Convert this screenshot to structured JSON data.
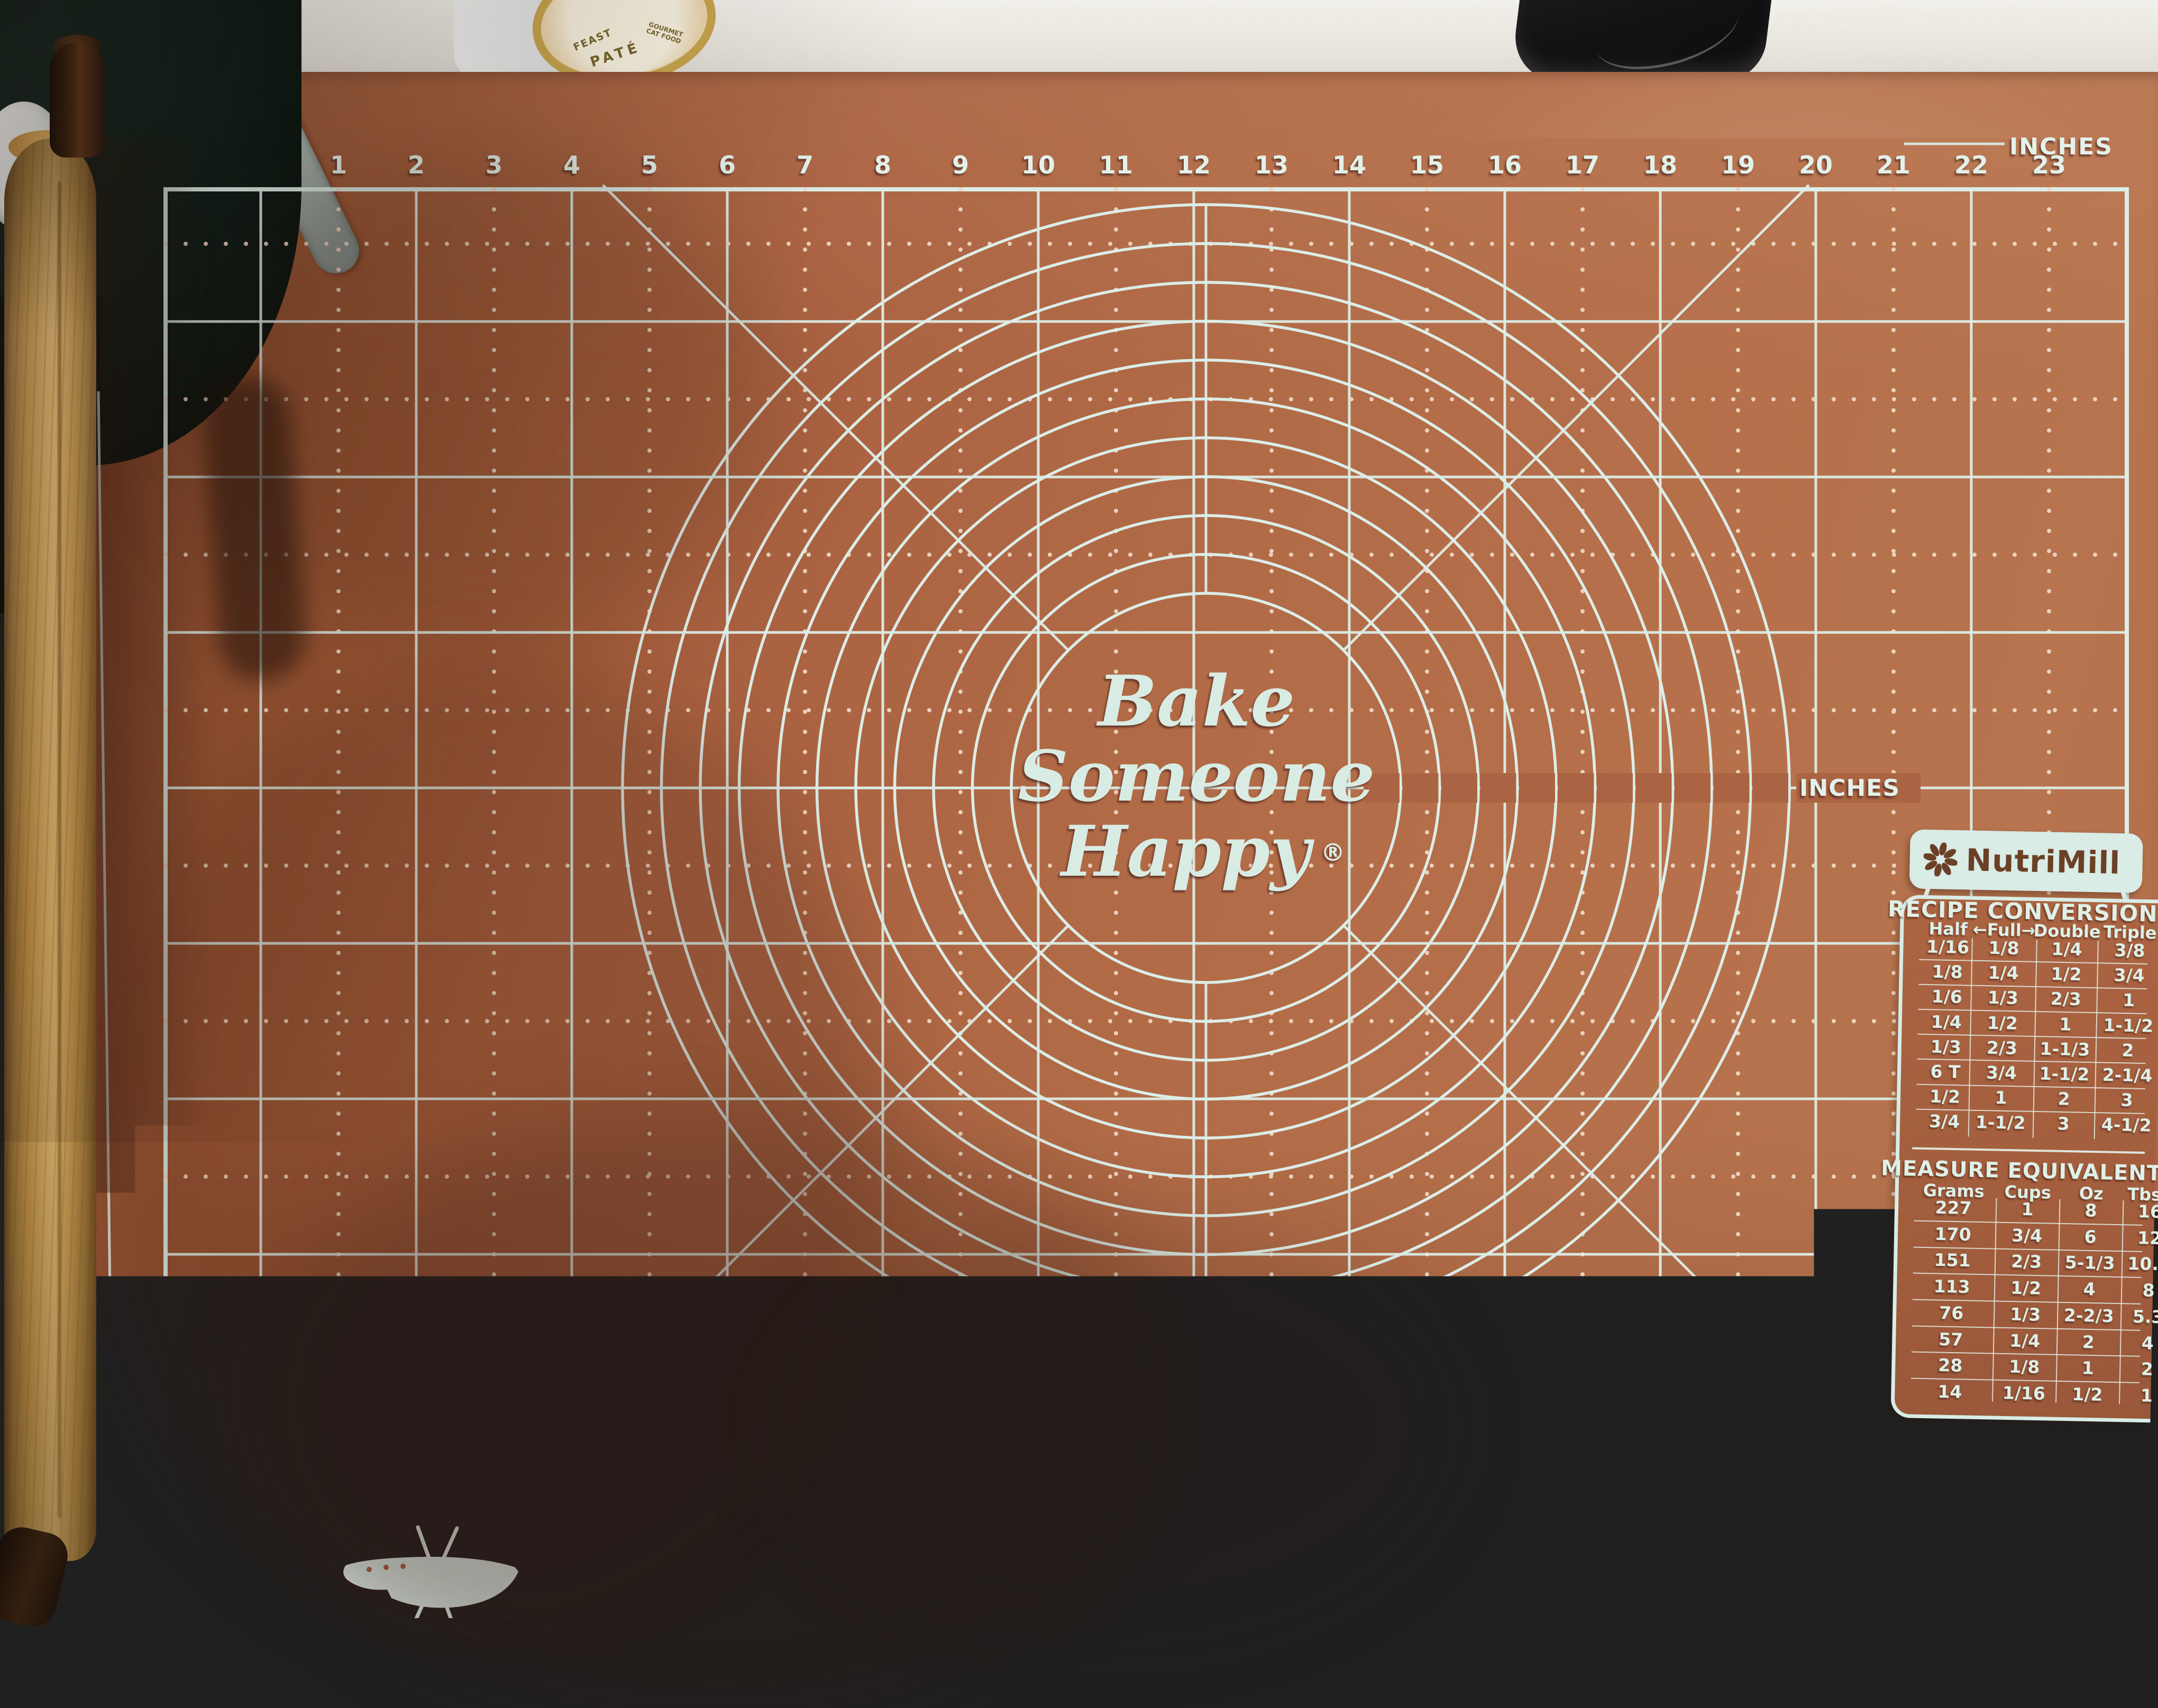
{
  "mat": {
    "center_logo": {
      "line1": "Bake",
      "line2": "Someone",
      "line3": "Happy",
      "registered": "®"
    },
    "rulers": {
      "top": {
        "unit": "INCHES",
        "numbers": [
          1,
          2,
          3,
          4,
          5,
          6,
          7,
          8,
          9,
          10,
          11,
          12,
          13,
          14,
          15,
          16,
          17,
          18,
          19,
          20,
          21,
          22,
          23
        ]
      },
      "bottom": {
        "unit": "CENTIMETERS",
        "numbers": [
          1,
          2,
          3,
          4,
          5,
          6,
          7,
          8,
          9,
          10,
          11,
          12,
          13,
          14,
          15,
          16,
          17,
          18,
          19,
          20,
          21,
          22,
          23,
          24,
          25,
          26,
          27,
          28,
          29,
          30,
          31,
          32,
          33,
          34,
          35,
          36,
          37,
          38,
          39,
          40,
          41,
          42,
          43,
          44,
          45,
          46,
          47,
          48,
          49,
          50,
          51,
          52,
          53,
          54,
          55,
          56,
          57
        ]
      },
      "left": {
        "numbers": [
          37,
          38,
          39,
          40
        ]
      },
      "right": {
        "numbers": [
          1,
          2,
          3
        ]
      },
      "circles": {
        "unit": "INCHES",
        "numbers": [
          5,
          6,
          7,
          8,
          9,
          10,
          11,
          12,
          13,
          14,
          15
        ]
      }
    },
    "nutrimill": {
      "brand": "NutriMill",
      "recipe_conversions": {
        "title": "RECIPE CONVERSIONS",
        "headers": [
          "Half",
          "Full",
          "Double",
          "Triple"
        ],
        "full_arrow_left": "←",
        "full_arrow_right": "→",
        "rows": [
          [
            "1/16",
            "1/8",
            "1/4",
            "3/8"
          ],
          [
            "1/8",
            "1/4",
            "1/2",
            "3/4"
          ],
          [
            "1/6",
            "1/3",
            "2/3",
            "1"
          ],
          [
            "1/4",
            "1/2",
            "1",
            "1-1/2"
          ],
          [
            "1/3",
            "2/3",
            "1-1/3",
            "2"
          ],
          [
            "6 T",
            "3/4",
            "1-1/2",
            "2-1/4"
          ],
          [
            "1/2",
            "1",
            "2",
            "3"
          ],
          [
            "3/4",
            "1-1/2",
            "3",
            "4-1/2"
          ]
        ]
      },
      "measure_equivalents": {
        "title": "MEASURE EQUIVALENTS",
        "headers": [
          "Grams",
          "Cups",
          "Oz",
          "Tbsp"
        ],
        "rows": [
          [
            "227",
            "1",
            "8",
            "16"
          ],
          [
            "170",
            "3/4",
            "6",
            "12"
          ],
          [
            "151",
            "2/3",
            "5-1/3",
            "10.6"
          ],
          [
            "113",
            "1/2",
            "4",
            "8"
          ],
          [
            "76",
            "1/3",
            "2-2/3",
            "5.3"
          ],
          [
            "57",
            "1/4",
            "2",
            "4"
          ],
          [
            "28",
            "1/8",
            "1",
            "2"
          ],
          [
            "14",
            "1/16",
            "1/2",
            "1"
          ]
        ]
      }
    }
  },
  "objects": {
    "can_label": {
      "line1": "FEAST",
      "line2": "PATÉ",
      "line3": "GOURMET CAT FOOD"
    }
  },
  "colors": {
    "mat": "#ab6443",
    "print": "#dcede7",
    "dots": "#eed6c2",
    "badge": "#d9ece6",
    "badge_text": "#6b4026",
    "pot": "#10201b",
    "wood": "#d3a355"
  }
}
